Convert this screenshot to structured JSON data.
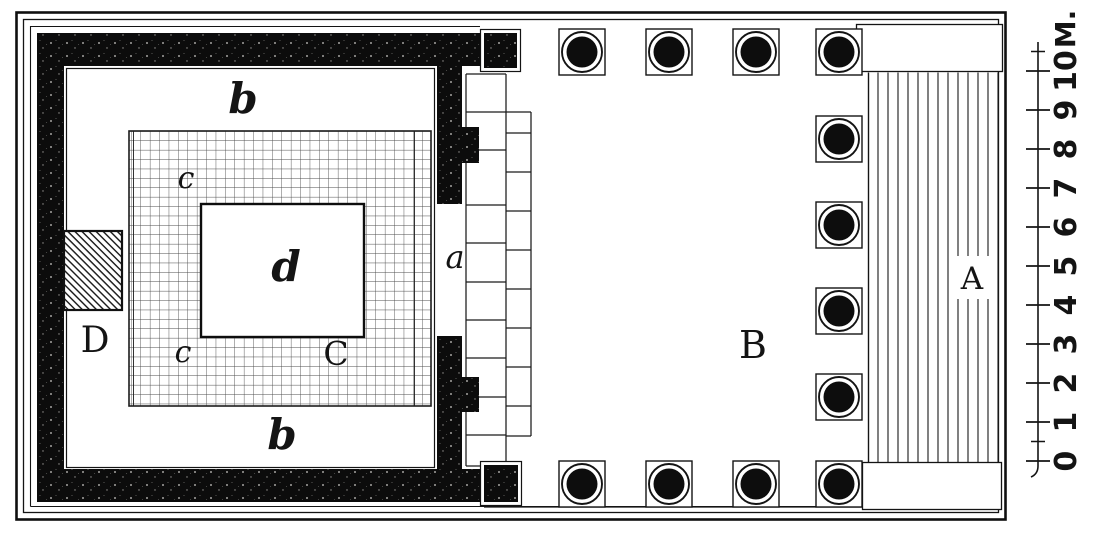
{
  "figure": {
    "kind": "temple floor plan (woodcut engraving)",
    "ink_color": "#141414",
    "paper_color": "#ffffff"
  },
  "labels": {
    "steps": "A",
    "pronaos": "B",
    "hall": "C",
    "hall_floor_top": "c",
    "hall_floor_bottom": "c",
    "corridor_top": "b",
    "corridor_bottom": "b",
    "sanctuary": "d",
    "side_chamber": "D",
    "doorway": "a"
  },
  "scale": {
    "unit": "M.",
    "meters_min": 0,
    "meters_max": 10,
    "ticks": [
      "0",
      "1",
      "2",
      "3",
      "4",
      "5",
      "6",
      "7",
      "8",
      "9",
      "10"
    ]
  },
  "columns": {
    "count": 12
  }
}
